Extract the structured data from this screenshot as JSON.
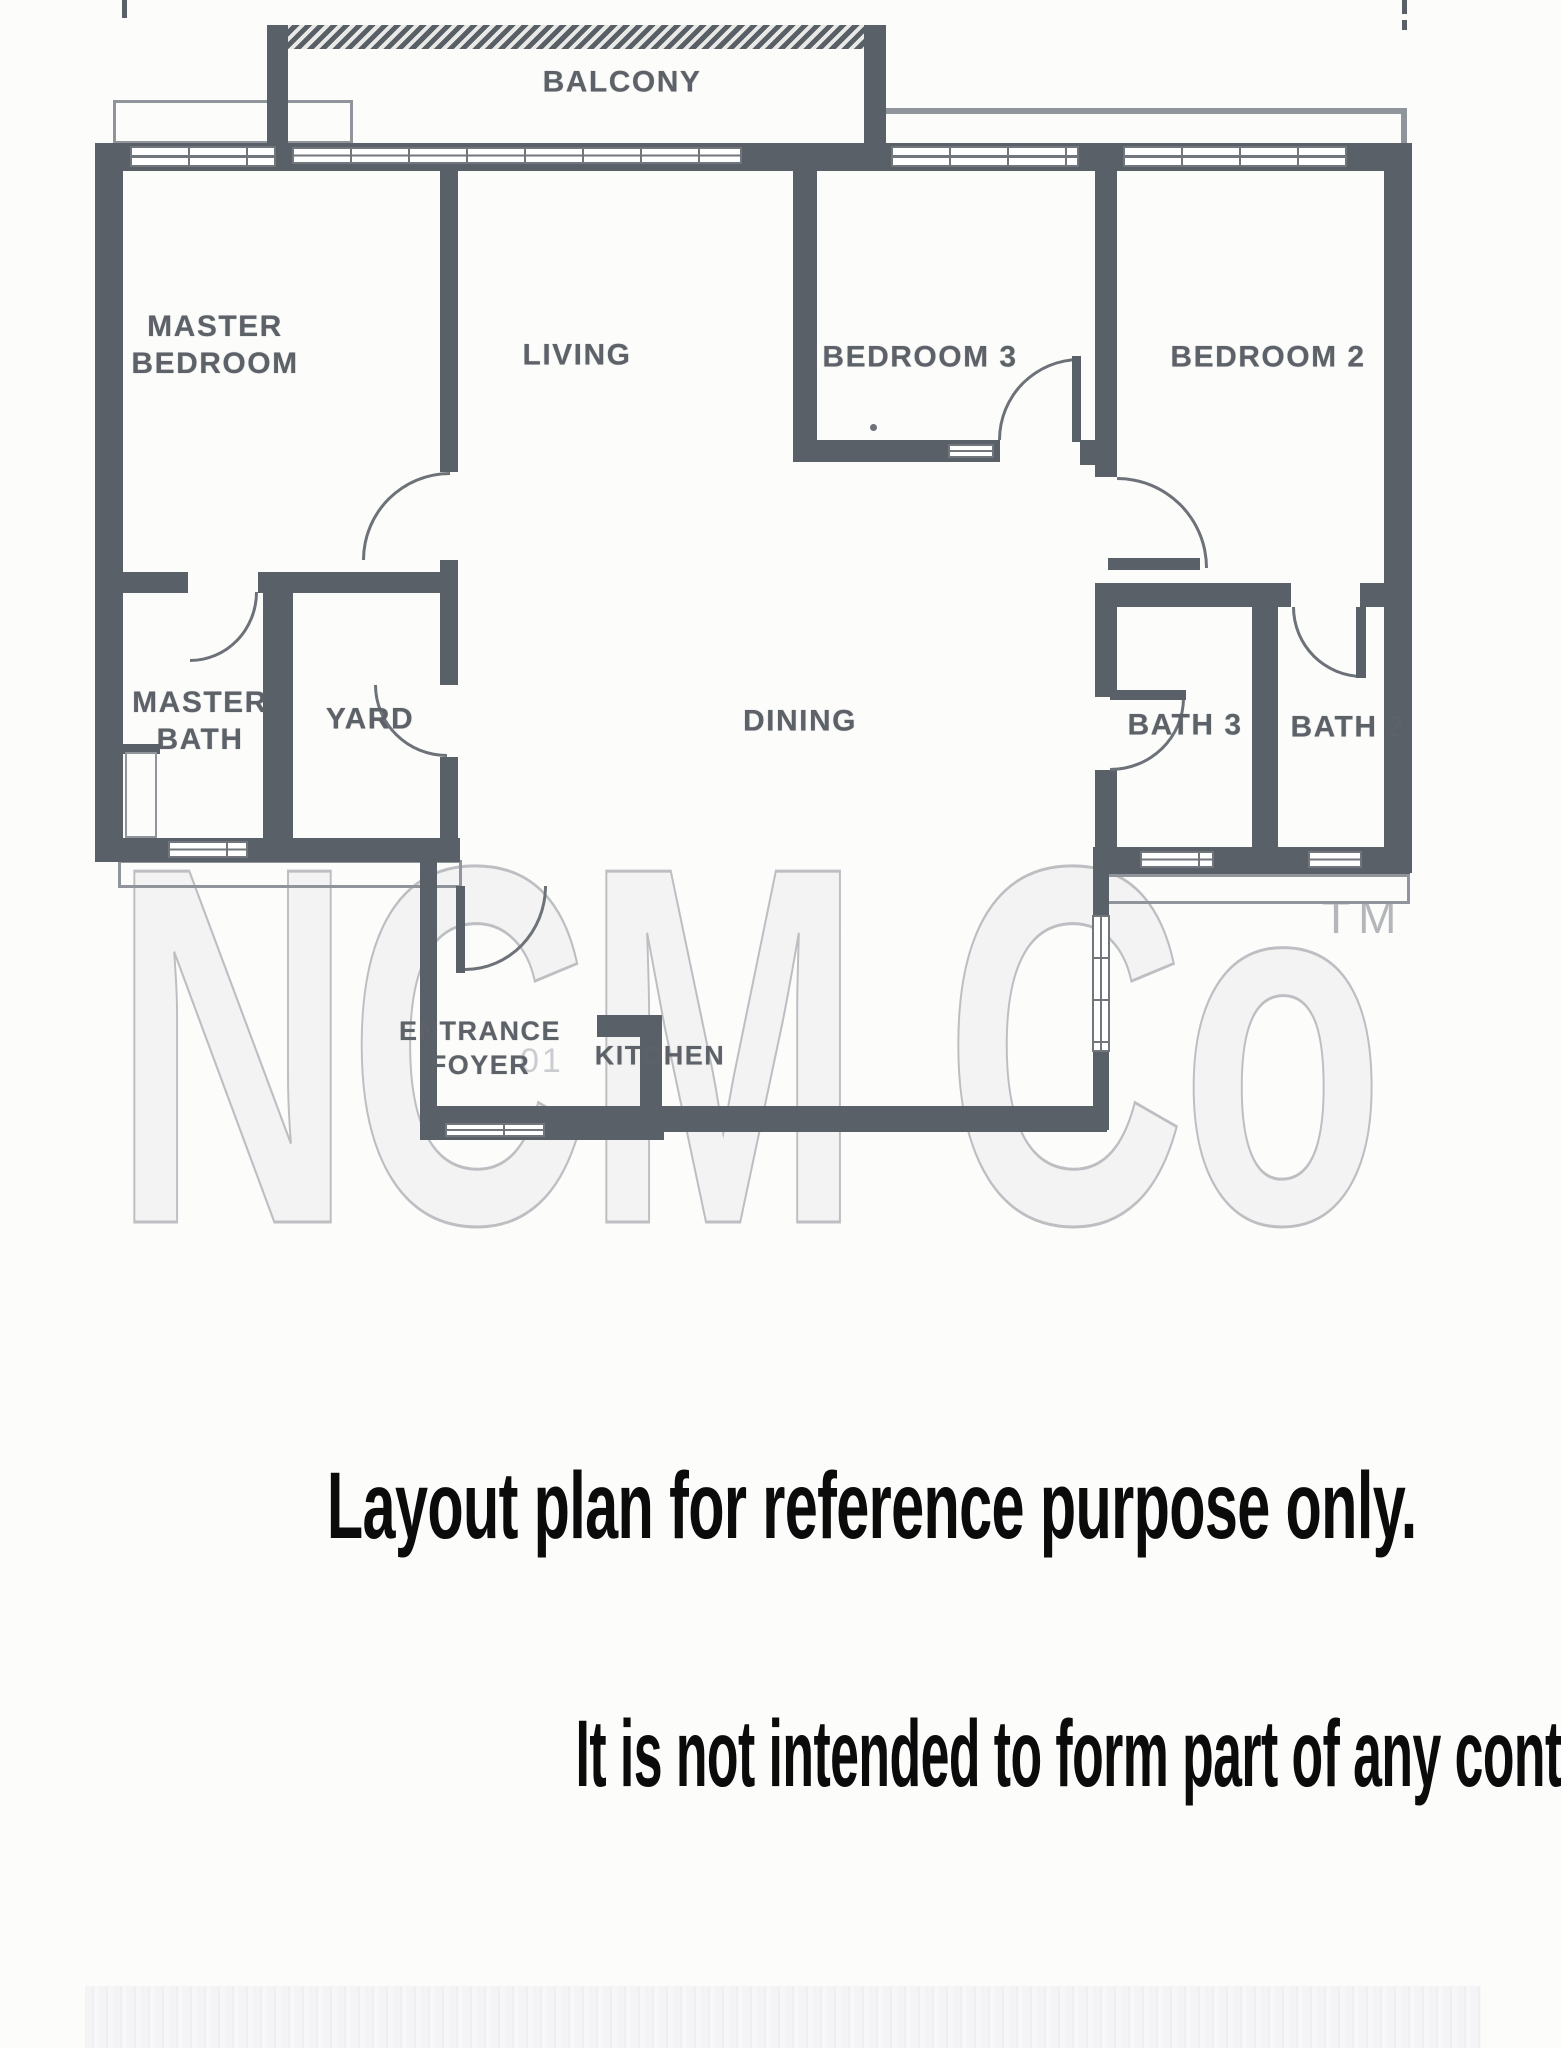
{
  "rooms": {
    "balcony": {
      "label": "BALCONY"
    },
    "master_bedroom": {
      "line1": "MASTER",
      "line2": "BEDROOM"
    },
    "living": {
      "label": "LIVING"
    },
    "bedroom3": {
      "label": "BEDROOM 3"
    },
    "bedroom2": {
      "label": "BEDROOM 2"
    },
    "master_bath": {
      "line1": "MASTER",
      "line2": "BATH"
    },
    "yard": {
      "label": "YARD"
    },
    "dining": {
      "label": "DINING"
    },
    "bath3": {
      "label": "BATH 3"
    },
    "bath2": {
      "label": "BATH 2"
    },
    "entrance_foyer": {
      "line1": "ENTRANCE",
      "line2": "FOYER"
    },
    "kitchen": {
      "label": "KITCHEN"
    }
  },
  "watermark": {
    "text": "NCM Co",
    "tm": "TM",
    "digits": "01"
  },
  "disclaimer": {
    "line1": "Layout plan for reference purpose only.",
    "line2": "It is not intended to form part of any contract or warranty."
  },
  "colors": {
    "wall": "#5a6067",
    "arc": "#6d7278",
    "label": "#5d6268",
    "ledge": "#8f959b",
    "watermark": "#b4b6ba",
    "disclaimer": "#0b0b0b",
    "background": "#fcfcfb"
  }
}
